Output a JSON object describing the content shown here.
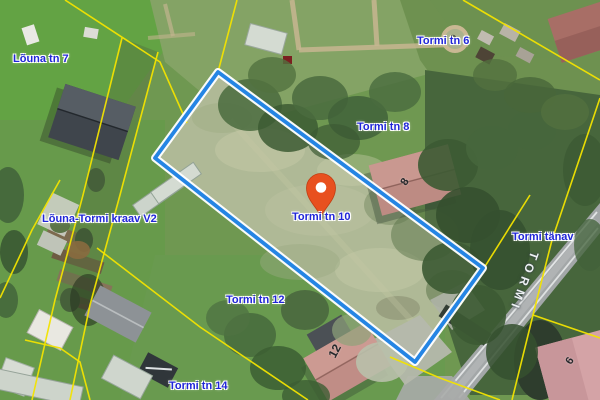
{
  "map": {
    "view": "aerial-cadastral",
    "labels": {
      "louna_tn_7": "Lõuna tn 7",
      "tormi_tn_6": "Tormi tn 6",
      "tormi_tn_8": "Tormi tn 8",
      "tormi_tn_10": "Tormi tn 10",
      "louna_tormi_kraav": "Lõuna-Tormi kraav V2",
      "tormi_tanav": "Tormi tänav",
      "tormi_tn_12": "Tormi tn 12",
      "tormi_tn_14": "Tormi tn 14"
    },
    "roof_numbers": {
      "tormi_8": "8",
      "tormi_12": "12",
      "tormi_6": "6"
    },
    "road_name": "TORMI",
    "colors": {
      "parcel_highlight": "#2585e4",
      "cadastral_line": "#f2e300",
      "street_label": "#2026d8",
      "marker": "#e8501f"
    }
  }
}
